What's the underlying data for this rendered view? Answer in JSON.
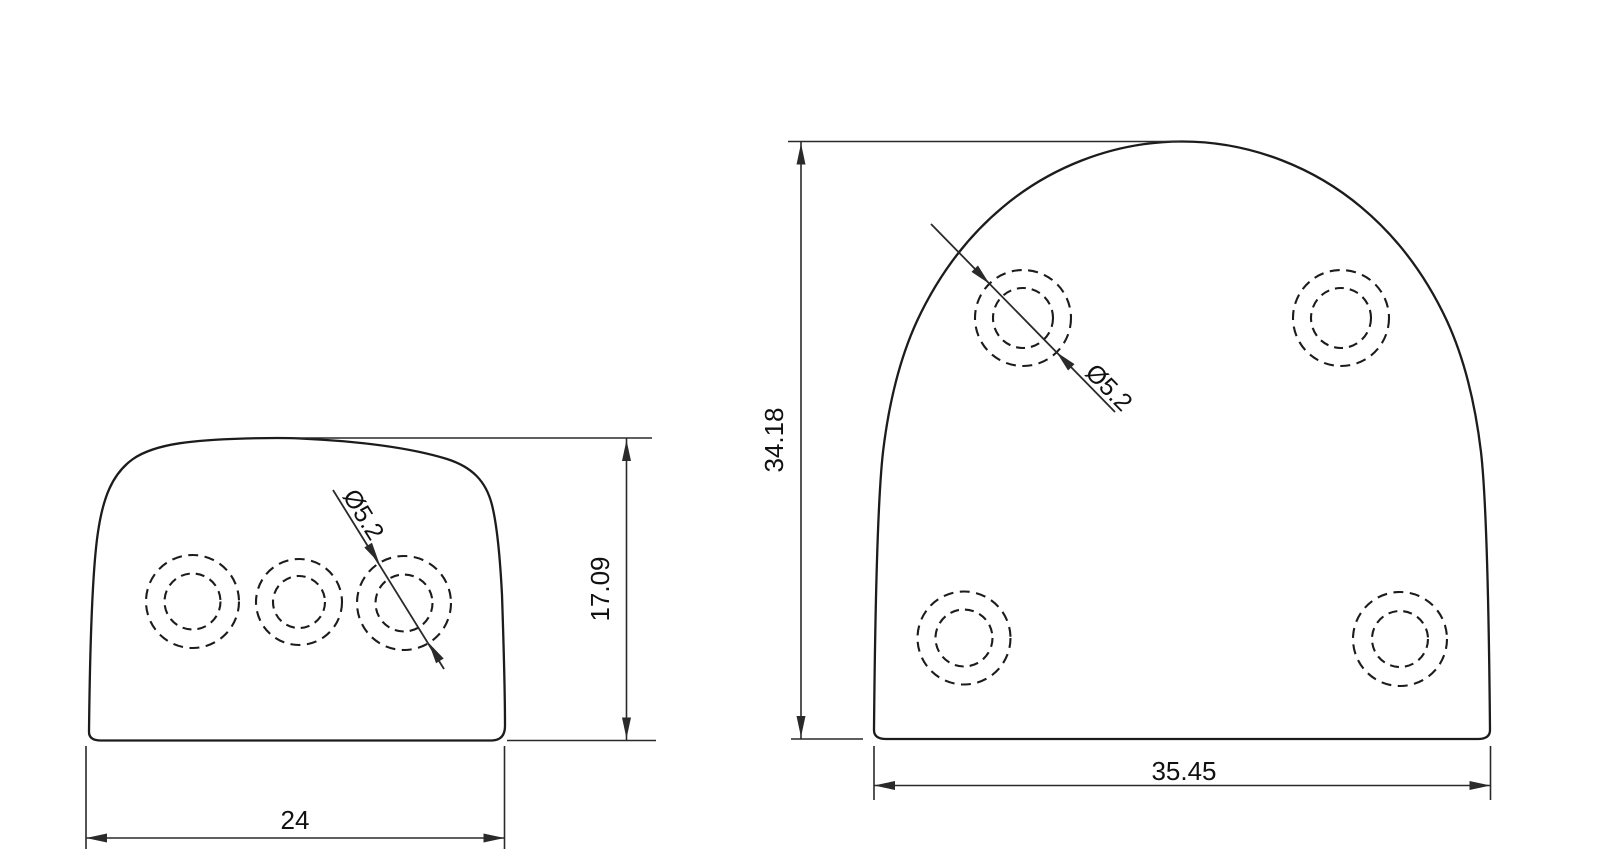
{
  "drawing": {
    "type": "2D technical drawing, two orthographic views of a rounded bracket plate",
    "colors": {
      "background": "#ffffff",
      "line": "#1c1c1c",
      "dimension": "#2a2a2a"
    },
    "side_view": {
      "width_label": "24",
      "height_label": "17.09",
      "hole_diameter_label": "Ø5.2",
      "hole_count": 3
    },
    "front_view": {
      "width_label": "35.45",
      "height_label": "34.18",
      "hole_diameter_label": "Ø5.2",
      "hole_count": 4
    }
  }
}
